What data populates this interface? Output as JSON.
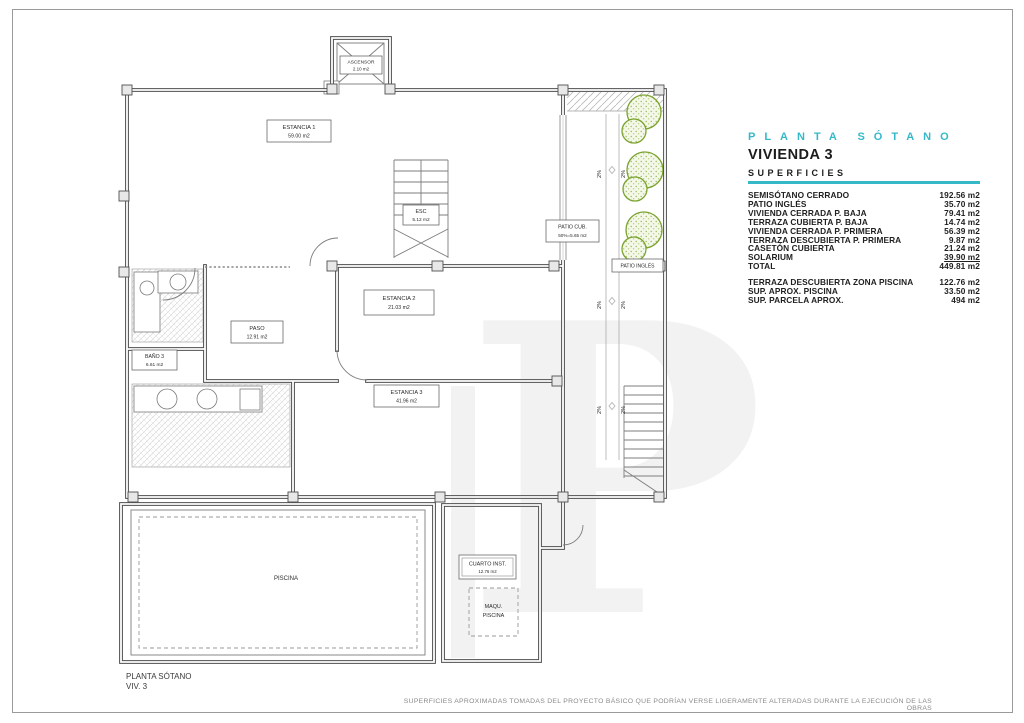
{
  "title_block": {
    "plan_title": "PLANTA SÓTANO",
    "dwelling": "VIVIENDA 3",
    "section_heading": "SUPERFICIES",
    "accent_color": "#35b9c9",
    "rows": [
      {
        "label": "SEMISÓTANO CERRADO",
        "value": "192.56 m2"
      },
      {
        "label": "PATIO INGLÉS",
        "value": "35.70 m2"
      },
      {
        "label": "VIVIENDA CERRADA P. BAJA",
        "value": "79.41 m2"
      },
      {
        "label": "TERRAZA CUBIERTA P. BAJA",
        "value": "14.74 m2"
      },
      {
        "label": "VIVIENDA CERRADA P. PRIMERA",
        "value": "56.39 m2"
      },
      {
        "label": "TERRAZA DESCUBIERTA P. PRIMERA",
        "value": "9.87 m2"
      },
      {
        "label": "CASETÓN CUBIERTA",
        "value": "21.24 m2"
      },
      {
        "label": "SOLARIUM",
        "value": "39.90 m2"
      },
      {
        "label": "TOTAL",
        "value": "449.81 m2"
      }
    ],
    "rows_secondary": [
      {
        "label": "TERRAZA DESCUBIERTA ZONA PISCINA",
        "value": "122.76 m2"
      },
      {
        "label": "SUP. APROX. PISCINA",
        "value": "33.50 m2"
      },
      {
        "label": "SUP. PARCELA APROX.",
        "value": "494 m2"
      }
    ]
  },
  "plan": {
    "slope_label": "2%",
    "watermark_letter": "P",
    "rooms": {
      "ascensor": {
        "name": "ASCENSOR",
        "area": "2.10 m2"
      },
      "estancia1": {
        "name": "ESTANCIA 1",
        "area": "59.00 m2"
      },
      "esc": {
        "name": "ESC",
        "area": "5.12 m2"
      },
      "patio_cub": {
        "name": "PATIO CUB.",
        "area": "50%=5.65 m2"
      },
      "patio_ingles": {
        "name": "PATIO INGLÉS"
      },
      "estancia2": {
        "name": "ESTANCIA 2",
        "area": "21.03 m2"
      },
      "paso": {
        "name": "PASO",
        "area": "12.91 m2"
      },
      "bano3": {
        "name": "BAÑO 3",
        "area": "6.61 m2"
      },
      "estancia3": {
        "name": "ESTANCIA 3",
        "area": "41.96 m2"
      },
      "piscina": {
        "name": "PISCINA"
      },
      "cuarto_inst": {
        "name": "CUARTO INST.",
        "area": "12.76 m2"
      },
      "maqu_piscina": {
        "line1": "MAQU.",
        "line2": "PISCINA"
      }
    }
  },
  "footer": {
    "plan_name": "PLANTA SÓTANO",
    "dwelling_ref": "VIV. 3",
    "disclaimer": "SUPERFICIES APROXIMADAS TOMADAS DEL PROYECTO BÁSICO QUE PODRÍAN VERSE LIGERAMENTE ALTERADAS DURANTE LA EJECUCIÓN DE LAS OBRAS"
  }
}
